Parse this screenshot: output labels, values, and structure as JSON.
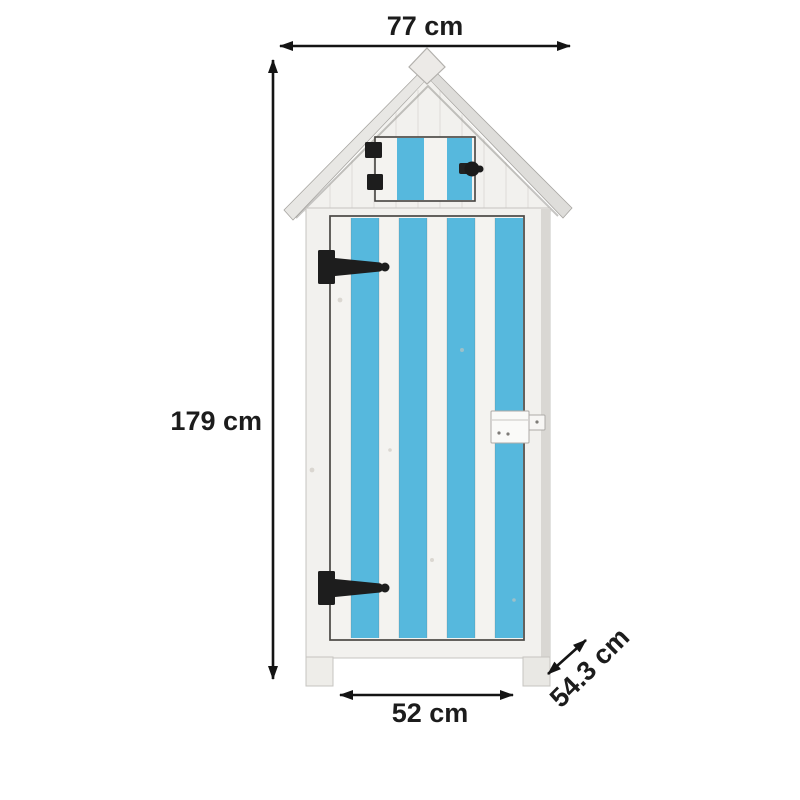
{
  "dimensions": {
    "width": "77 cm",
    "height": "179 cm",
    "door_width": "52 cm",
    "depth": "54.3 cm"
  },
  "colors": {
    "stripe_blue": "#56b8dd",
    "wood_white": "#f2f1ee",
    "roof_gray": "#e3e2df",
    "hardware_black": "#1d1d1d",
    "arrow_black": "#141414",
    "outline_dark": "#4a4844",
    "label_color": "#1c1c1c"
  }
}
